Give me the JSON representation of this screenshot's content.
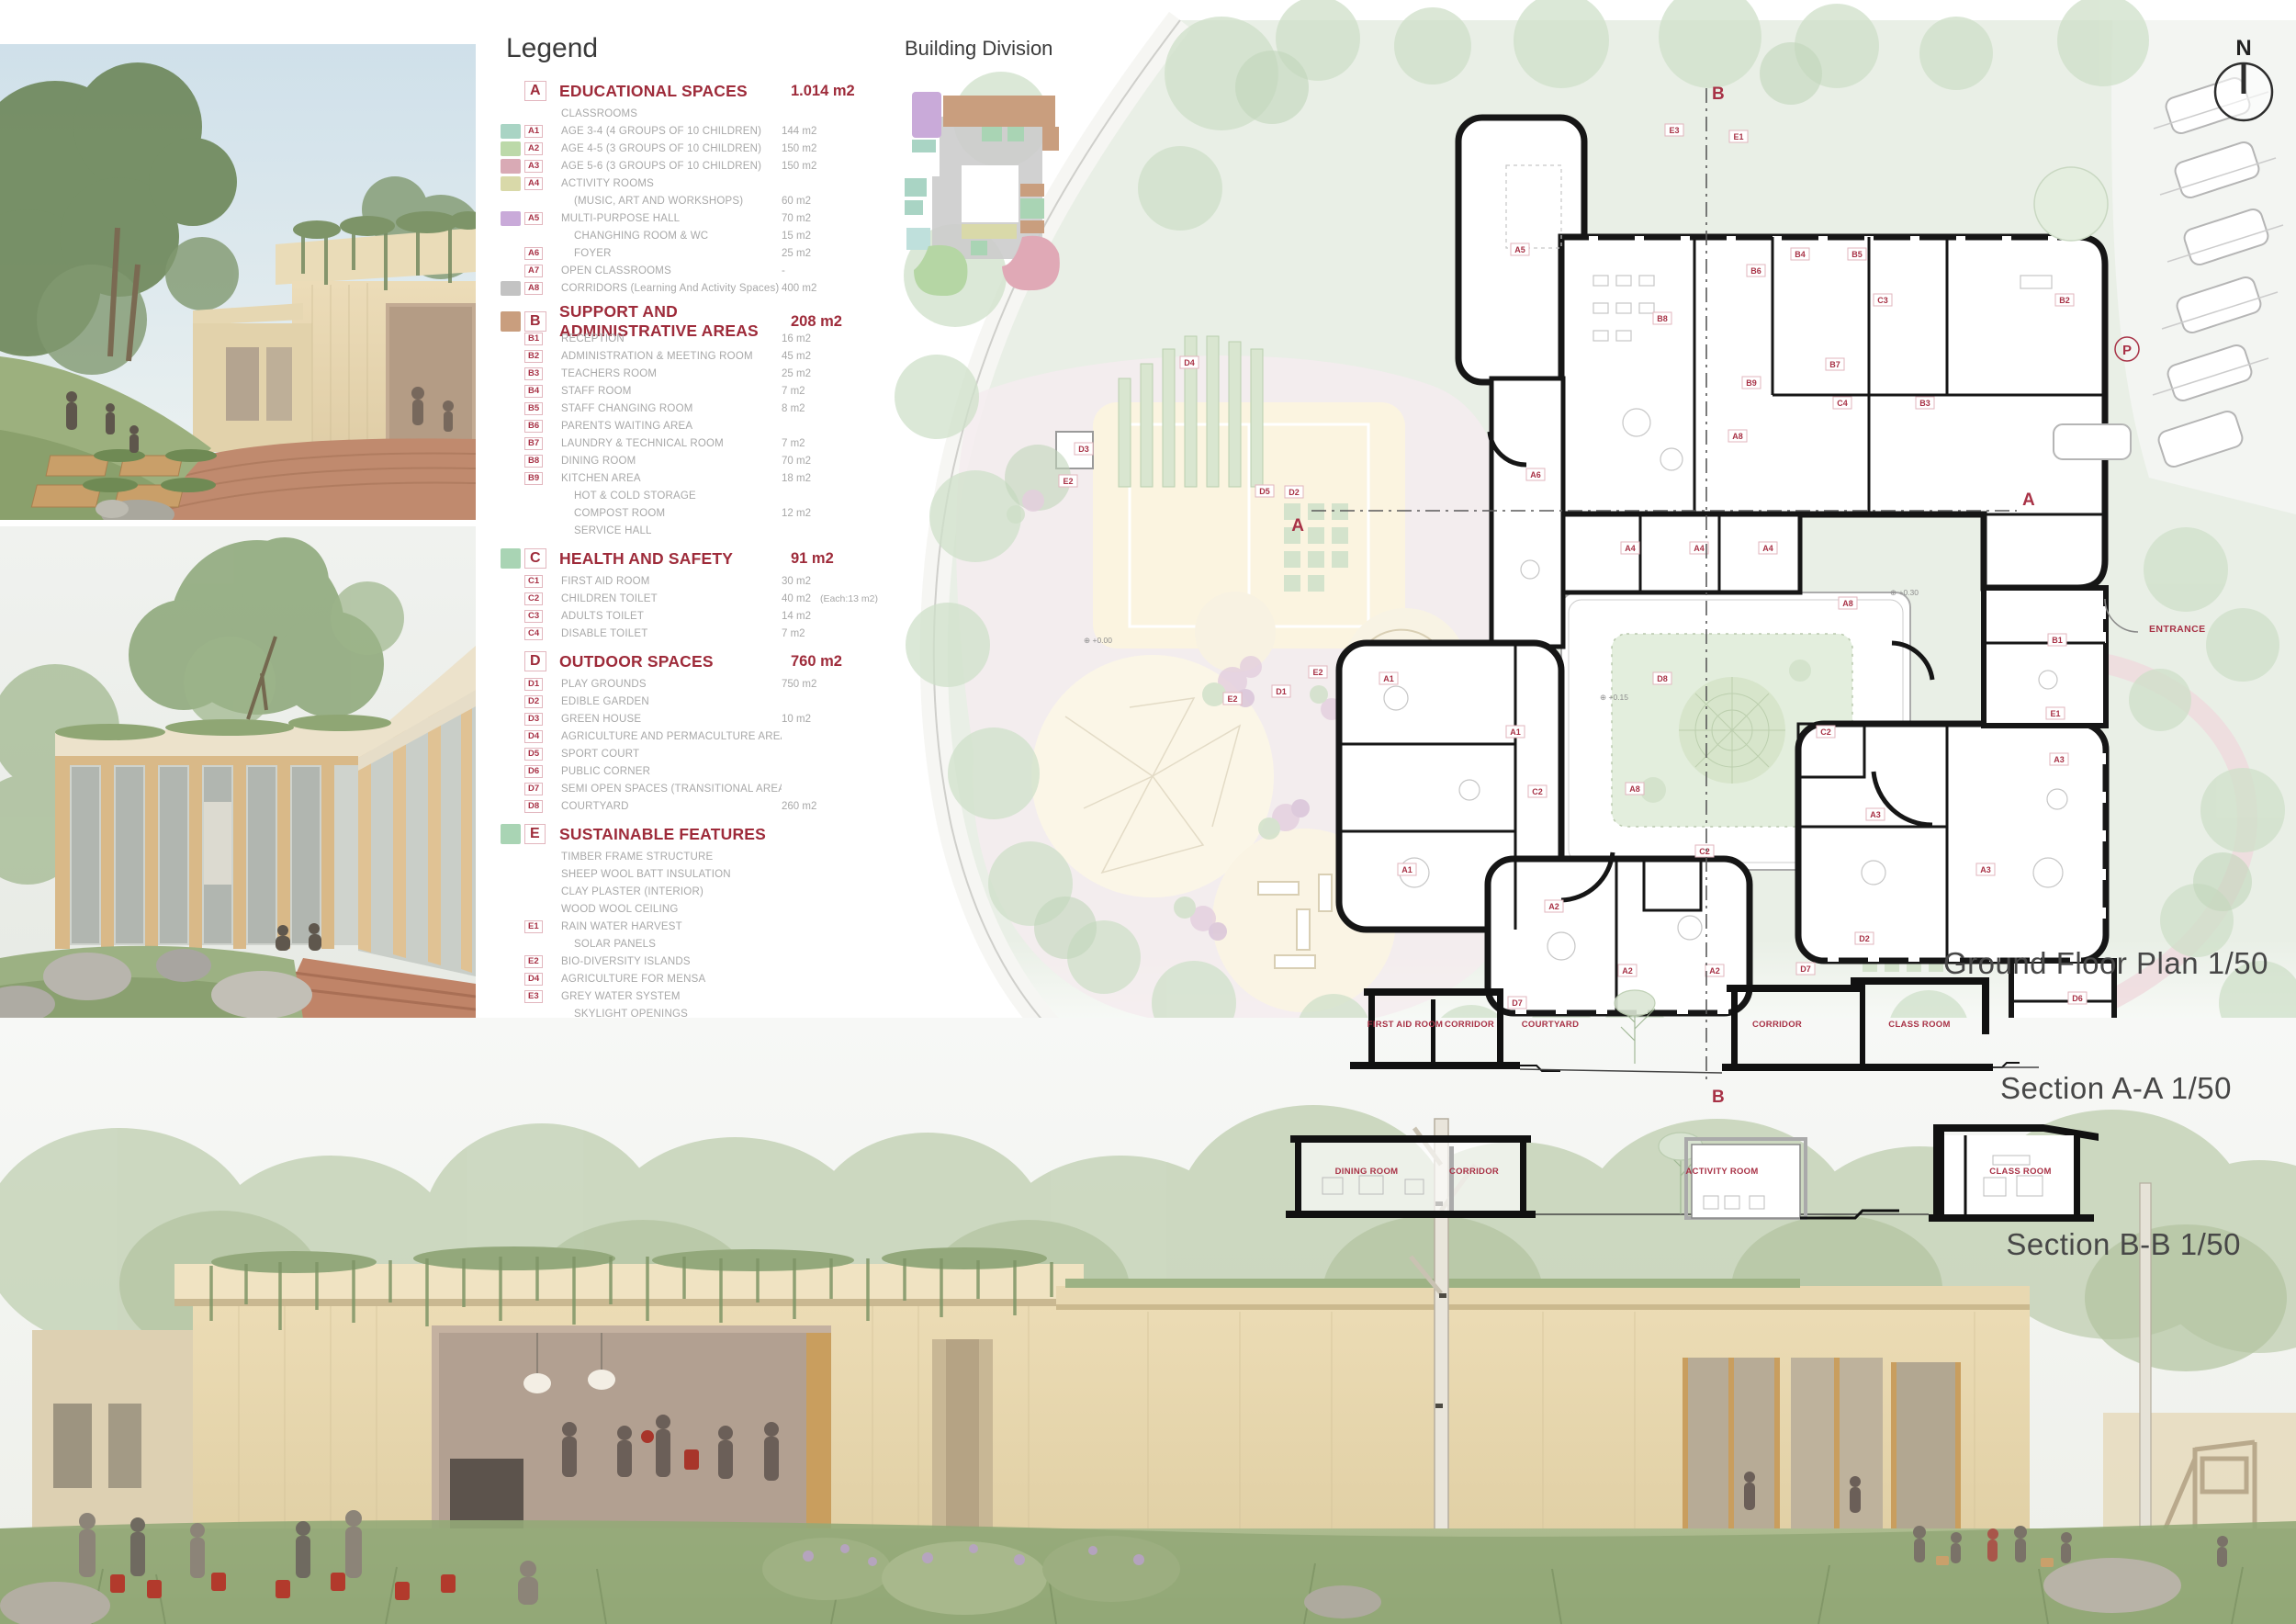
{
  "palette": {
    "legend_red": "#9e2b3a",
    "tag_red": "#a83246",
    "tag_border": "#e2b6be",
    "gray_text": "#a8a8a8",
    "swatch_teal": "#a9d4c4",
    "swatch_green": "#bcd9a9",
    "swatch_pink": "#d9aab5",
    "swatch_khaki": "#d9d9a9",
    "swatch_purple": "#c9aad9",
    "swatch_gray": "#c3c3c3",
    "swatch_brown": "#c99e7e",
    "swatch_mint": "#a9d4b4",
    "site_green": "#e9efe6",
    "plan_black": "#161616"
  },
  "legend": {
    "title": "Legend",
    "total_label": "TOTAL :",
    "total_value": "1.313 m2",
    "sections": [
      {
        "id": "A",
        "title": "EDUCATIONAL SPACES",
        "area": "1.014 m2",
        "swatch": null,
        "rows": [
          {
            "tag": "",
            "label": "CLASSROOMS",
            "area": "",
            "note": "",
            "swatch": null,
            "sub": false
          },
          {
            "tag": "A1",
            "label": "AGE 3-4  (4 GROUPS OF 10 CHILDREN)",
            "area": "144 m2",
            "note": "",
            "swatch": "#a9d4c4",
            "sub": false
          },
          {
            "tag": "A2",
            "label": "AGE 4-5  (3 GROUPS OF 10 CHILDREN)",
            "area": "150 m2",
            "note": "",
            "swatch": "#bcd9a9",
            "sub": false
          },
          {
            "tag": "A3",
            "label": "AGE 5-6  (3 GROUPS OF 10 CHILDREN)",
            "area": "150 m2",
            "note": "",
            "swatch": "#d9aab5",
            "sub": false
          },
          {
            "tag": "A4",
            "label": "ACTIVITY ROOMS",
            "area": "",
            "note": "",
            "swatch": "#d9d9a9",
            "sub": false
          },
          {
            "tag": "",
            "label": "(MUSIC, ART AND WORKSHOPS)",
            "area": "60 m2",
            "note": "",
            "swatch": null,
            "sub": true
          },
          {
            "tag": "A5",
            "label": "MULTI-PURPOSE HALL",
            "area": "70 m2",
            "note": "",
            "swatch": "#c9aad9",
            "sub": false
          },
          {
            "tag": "",
            "label": "CHANGHING ROOM & WC",
            "area": "15 m2",
            "note": "",
            "swatch": null,
            "sub": true
          },
          {
            "tag": "A6",
            "label": "FOYER",
            "area": "25 m2",
            "note": "",
            "swatch": null,
            "sub": true
          },
          {
            "tag": "A7",
            "label": "OPEN CLASSROOMS",
            "area": "-",
            "note": "",
            "swatch": null,
            "sub": false
          },
          {
            "tag": "A8",
            "label": "CORRIDORS (Learning And Activity Spaces)",
            "area": "400 m2",
            "note": "",
            "swatch": "#c3c3c3",
            "sub": false
          }
        ]
      },
      {
        "id": "B",
        "title": "SUPPORT AND ADMINISTRATIVE AREAS",
        "area": "208 m2",
        "swatch": "#c99e7e",
        "rows": [
          {
            "tag": "B1",
            "label": "RECEPTION",
            "area": "16 m2",
            "note": "",
            "swatch": null,
            "sub": false
          },
          {
            "tag": "B2",
            "label": "ADMINISTRATION & MEETING ROOM",
            "area": "45 m2",
            "note": "",
            "swatch": null,
            "sub": false
          },
          {
            "tag": "B3",
            "label": "TEACHERS ROOM",
            "area": "25 m2",
            "note": "",
            "swatch": null,
            "sub": false
          },
          {
            "tag": "B4",
            "label": "STAFF ROOM",
            "area": "7 m2",
            "note": "",
            "swatch": null,
            "sub": false
          },
          {
            "tag": "B5",
            "label": "STAFF CHANGING ROOM",
            "area": "8 m2",
            "note": "",
            "swatch": null,
            "sub": false
          },
          {
            "tag": "B6",
            "label": "PARENTS WAITING AREA",
            "area": "",
            "note": "",
            "swatch": null,
            "sub": false
          },
          {
            "tag": "B7",
            "label": "LAUNDRY & TECHNICAL ROOM",
            "area": "7 m2",
            "note": "",
            "swatch": null,
            "sub": false
          },
          {
            "tag": "B8",
            "label": "DINING ROOM",
            "area": "70 m2",
            "note": "",
            "swatch": null,
            "sub": false
          },
          {
            "tag": "B9",
            "label": "KITCHEN AREA",
            "area": "18 m2",
            "note": "",
            "swatch": null,
            "sub": false
          },
          {
            "tag": "",
            "label": "HOT & COLD STORAGE",
            "area": "",
            "note": "",
            "swatch": null,
            "sub": true
          },
          {
            "tag": "",
            "label": "COMPOST ROOM",
            "area": "12 m2",
            "note": "",
            "swatch": null,
            "sub": true
          },
          {
            "tag": "",
            "label": "SERVICE HALL",
            "area": "",
            "note": "",
            "swatch": null,
            "sub": true
          }
        ]
      },
      {
        "id": "C",
        "title": "HEALTH AND SAFETY",
        "area": "91 m2",
        "swatch": "#a9d4b4",
        "rows": [
          {
            "tag": "C1",
            "label": "FIRST AID ROOM",
            "area": "30 m2",
            "note": "",
            "swatch": null,
            "sub": false
          },
          {
            "tag": "C2",
            "label": "CHILDREN TOILET",
            "area": "40 m2",
            "note": "(Each:13 m2)",
            "swatch": null,
            "sub": false
          },
          {
            "tag": "C3",
            "label": "ADULTS TOILET",
            "area": "14 m2",
            "note": "",
            "swatch": null,
            "sub": false
          },
          {
            "tag": "C4",
            "label": "DISABLE TOILET",
            "area": "7 m2",
            "note": "",
            "swatch": null,
            "sub": false
          }
        ]
      },
      {
        "id": "D",
        "title": "OUTDOOR SPACES",
        "area": "760 m2",
        "swatch": null,
        "rows": [
          {
            "tag": "D1",
            "label": "PLAY GROUNDS",
            "area": "750 m2",
            "note": "",
            "swatch": null,
            "sub": false
          },
          {
            "tag": "D2",
            "label": "EDIBLE GARDEN",
            "area": "",
            "note": "",
            "swatch": null,
            "sub": false
          },
          {
            "tag": "D3",
            "label": "GREEN HOUSE",
            "area": "10 m2",
            "note": "",
            "swatch": null,
            "sub": false
          },
          {
            "tag": "D4",
            "label": "AGRICULTURE AND PERMACULTURE AREAS",
            "area": "",
            "note": "",
            "swatch": null,
            "sub": false
          },
          {
            "tag": "D5",
            "label": "SPORT COURT",
            "area": "",
            "note": "",
            "swatch": null,
            "sub": false
          },
          {
            "tag": "D6",
            "label": "PUBLIC CORNER",
            "area": "",
            "note": "",
            "swatch": null,
            "sub": false
          },
          {
            "tag": "D7",
            "label": "SEMI OPEN SPACES (TRANSITIONAL AREAS)",
            "area": "",
            "note": "",
            "swatch": null,
            "sub": false
          },
          {
            "tag": "D8",
            "label": "COURTYARD",
            "area": "260 m2",
            "note": "",
            "swatch": null,
            "sub": false
          }
        ]
      },
      {
        "id": "E",
        "title": "SUSTAINABLE FEATURES",
        "area": "",
        "swatch": "#a9d4b4",
        "rows": [
          {
            "tag": "",
            "label": "TIMBER FRAME STRUCTURE",
            "area": "",
            "note": "",
            "swatch": null,
            "sub": false
          },
          {
            "tag": "",
            "label": "SHEEP WOOL BATT INSULATION",
            "area": "",
            "note": "",
            "swatch": null,
            "sub": false
          },
          {
            "tag": "",
            "label": "CLAY PLASTER (INTERIOR)",
            "area": "",
            "note": "",
            "swatch": null,
            "sub": false
          },
          {
            "tag": "",
            "label": "WOOD WOOL CEILING",
            "area": "",
            "note": "",
            "swatch": null,
            "sub": false
          },
          {
            "tag": "E1",
            "label": "RAIN WATER HARVEST",
            "area": "",
            "note": "",
            "swatch": null,
            "sub": false
          },
          {
            "tag": "",
            "label": "SOLAR PANELS",
            "area": "",
            "note": "",
            "swatch": null,
            "sub": true
          },
          {
            "tag": "E2",
            "label": "BIO-DIVERSITY ISLANDS",
            "area": "",
            "note": "",
            "swatch": null,
            "sub": false
          },
          {
            "tag": "D4",
            "label": "AGRICULTURE FOR MENSA",
            "area": "",
            "note": "",
            "swatch": null,
            "sub": false
          },
          {
            "tag": "E3",
            "label": "GREY WATER SYSTEM",
            "area": "",
            "note": "",
            "swatch": null,
            "sub": false
          },
          {
            "tag": "",
            "label": "SKYLIGHT OPENINGS",
            "area": "",
            "note": "",
            "swatch": null,
            "sub": true
          }
        ]
      }
    ]
  },
  "building_division_title": "Building Division",
  "plan": {
    "title": "Ground Floor Plan 1/50",
    "north_label": "N",
    "entrance_label": "ENTRANCE",
    "parking_label": "P",
    "marker_a": "A",
    "marker_b": "B",
    "levels": [
      [
        "+0.00",
        1180,
        700
      ],
      [
        "+0.15",
        1742,
        762
      ],
      [
        "+0.30",
        2058,
        648
      ]
    ],
    "tags": [
      [
        "E3",
        1813,
        145
      ],
      [
        "E1",
        1883,
        152
      ],
      [
        "D5",
        1367,
        538
      ],
      [
        "D3",
        1170,
        492
      ],
      [
        "E2",
        1153,
        527
      ],
      [
        "D2",
        1399,
        539
      ],
      [
        "D1",
        1385,
        756
      ],
      [
        "E2",
        1332,
        764
      ],
      [
        "E2",
        1425,
        735
      ],
      [
        "D4",
        1285,
        398
      ],
      [
        "D2",
        2020,
        1025
      ],
      [
        "A5",
        1645,
        275
      ],
      [
        "A4",
        1765,
        600
      ],
      [
        "A4",
        1840,
        600
      ],
      [
        "A4",
        1915,
        600
      ],
      [
        "B8",
        1800,
        350
      ],
      [
        "B6",
        1902,
        298
      ],
      [
        "B4",
        1950,
        280
      ],
      [
        "B5",
        2012,
        280
      ],
      [
        "B9",
        1897,
        420
      ],
      [
        "B7",
        1988,
        400
      ],
      [
        "C3",
        2040,
        330
      ],
      [
        "C4",
        1996,
        442
      ],
      [
        "B3",
        2086,
        442
      ],
      [
        "B2",
        2238,
        330
      ],
      [
        "A6",
        1662,
        520
      ],
      [
        "A8",
        1882,
        478
      ],
      [
        "A8",
        2002,
        660
      ],
      [
        "A8",
        1770,
        862
      ],
      [
        "A1",
        1502,
        742
      ],
      [
        "A1",
        1640,
        800
      ],
      [
        "A1",
        1522,
        950
      ],
      [
        "C2",
        1664,
        865
      ],
      [
        "A2",
        1682,
        990
      ],
      [
        "A2",
        1762,
        1060
      ],
      [
        "A2",
        1857,
        1060
      ],
      [
        "C2",
        1846,
        930
      ],
      [
        "D7",
        1642,
        1095
      ],
      [
        "A3",
        2032,
        890
      ],
      [
        "A3",
        2152,
        950
      ],
      [
        "A3",
        2232,
        830
      ],
      [
        "C2",
        1978,
        800
      ],
      [
        "D7",
        1956,
        1058
      ],
      [
        "B1",
        2230,
        700
      ],
      [
        "E1",
        2228,
        780
      ],
      [
        "D6",
        2252,
        1090
      ],
      [
        "D8",
        1800,
        742
      ]
    ]
  },
  "sections": [
    {
      "title": "Section A-A 1/50",
      "labels": [
        [
          "FIRST AID ROOM",
          100,
          60
        ],
        [
          "CORRIDOR",
          170,
          60
        ],
        [
          "COURTYARD",
          258,
          60
        ],
        [
          "CORRIDOR",
          505,
          60
        ],
        [
          "CLASS ROOM",
          660,
          60
        ]
      ]
    },
    {
      "title": "Section B-B 1/50",
      "labels": [
        [
          "DINING ROOM",
          88,
          56
        ],
        [
          "CORRIDOR",
          205,
          56
        ],
        [
          "ACTIVITY ROOM",
          475,
          56
        ],
        [
          "CLASS ROOM",
          800,
          56
        ]
      ]
    }
  ]
}
